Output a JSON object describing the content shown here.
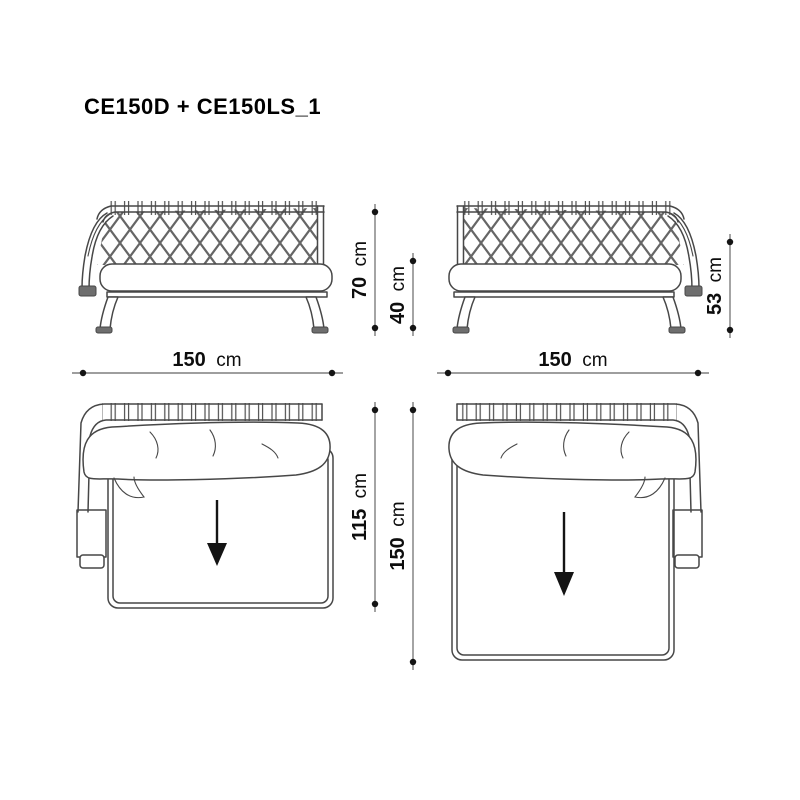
{
  "title": "CE150D + CE150LS_1",
  "colors": {
    "background": "#ffffff",
    "line": "#474747",
    "dim_line": "#7e7e7e",
    "marker": "#141414"
  },
  "dimensions": {
    "front_left_total_height": {
      "value": "70",
      "unit": "cm"
    },
    "front_left_seat_height": {
      "value": "40",
      "unit": "cm"
    },
    "front_left_width": {
      "value": "150",
      "unit": "cm"
    },
    "front_right_back_height": {
      "value": "53",
      "unit": "cm"
    },
    "front_right_width": {
      "value": "150",
      "unit": "cm"
    },
    "top_left_depth": {
      "value": "115",
      "unit": "cm"
    },
    "top_right_depth": {
      "value": "150",
      "unit": "cm"
    }
  }
}
